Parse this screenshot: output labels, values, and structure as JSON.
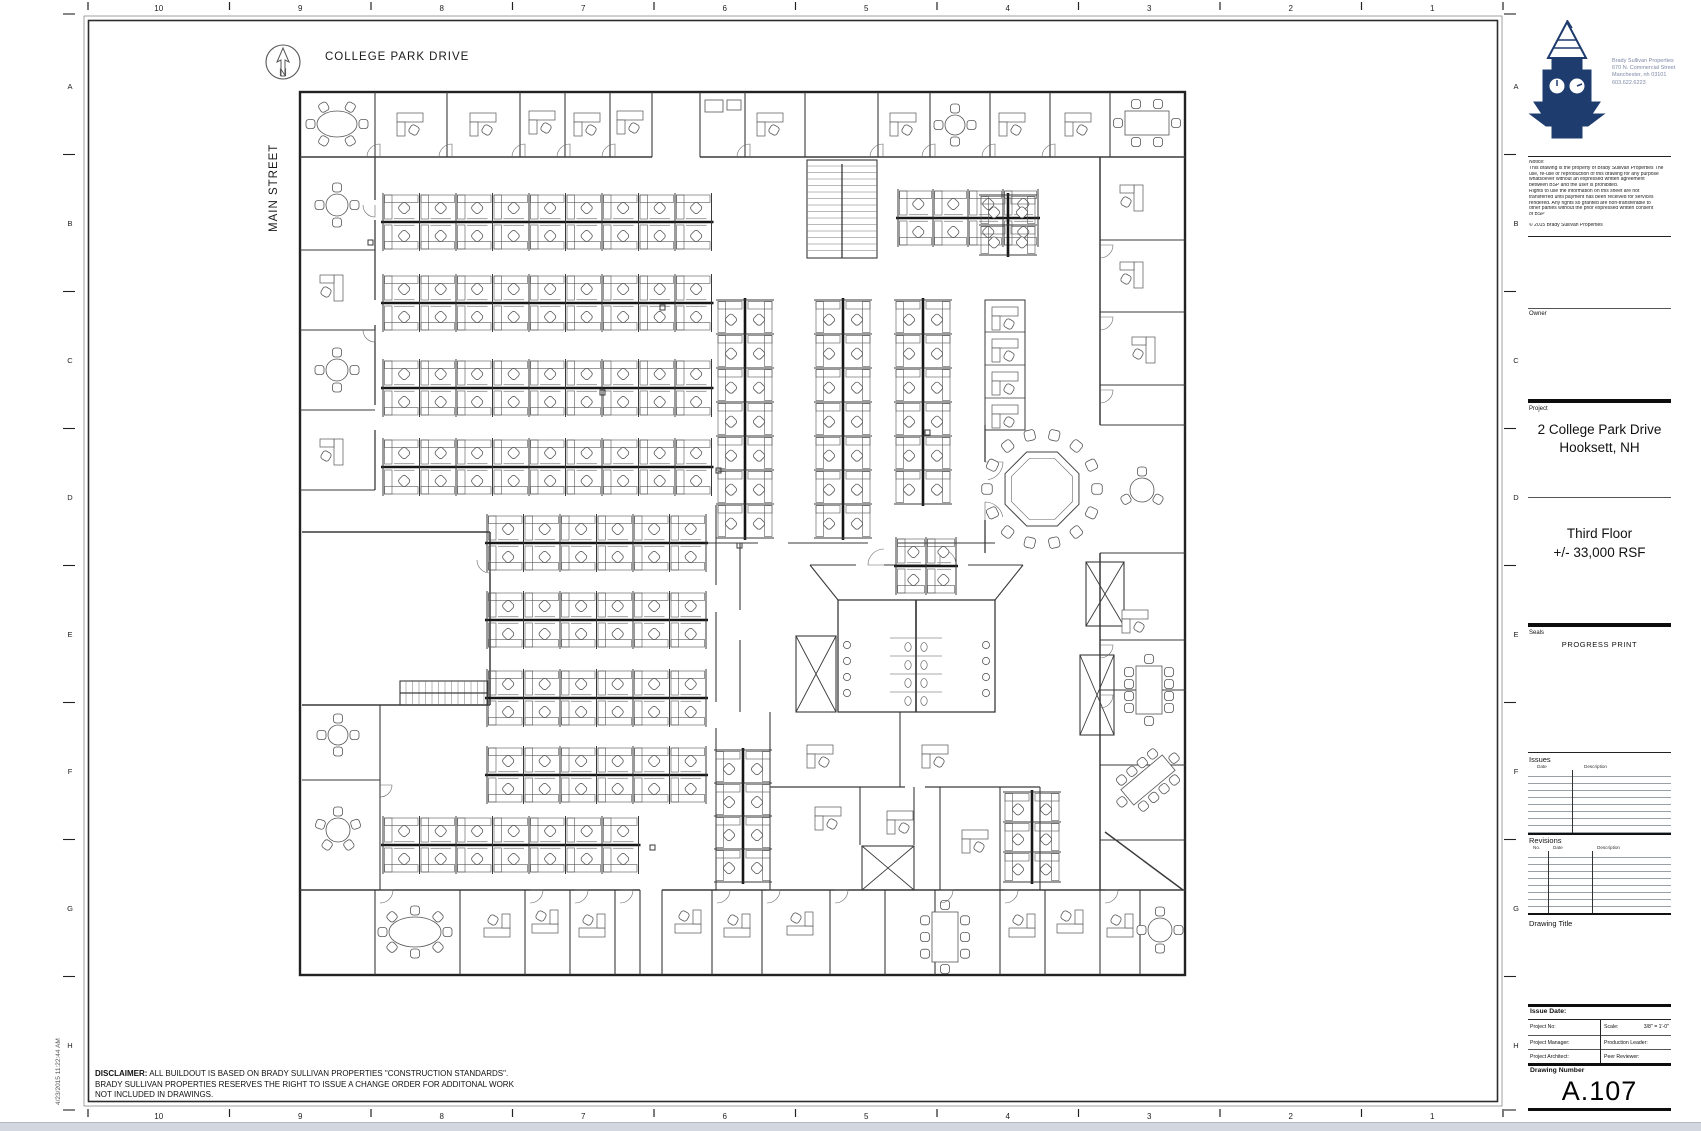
{
  "ruler": {
    "tick": "I",
    "top_numbers": [
      "10",
      "9",
      "8",
      "7",
      "6",
      "5",
      "4",
      "3",
      "2",
      "1"
    ],
    "bottom_numbers": [
      "10",
      "9",
      "8",
      "7",
      "6",
      "5",
      "4",
      "3",
      "2",
      "1"
    ],
    "left_letters": [
      "A",
      "B",
      "C",
      "D",
      "E",
      "F",
      "G",
      "H"
    ],
    "right_letters": [
      "A",
      "B",
      "C",
      "D",
      "E",
      "F",
      "G",
      "H"
    ]
  },
  "plan": {
    "street_top": "COLLEGE PARK DRIVE",
    "street_left": "MAIN STREET",
    "north_letter": "N"
  },
  "timestamp": "4/23/2015 11:22:44 AM",
  "disclaimer": {
    "label": "DISCLAIMER:",
    "text1": " ALL BUILDOUT IS BASED ON BRADY SULLIVAN PROPERTIES \"CONSTRUCTION STANDARDS\".",
    "line2": "BRADY SULLIVAN PROPERTIES RESERVES THE RIGHT TO ISSUE A CHANGE ORDER FOR ADDITONAL WORK",
    "line3": "NOT INCLUDED IN DRAWINGS."
  },
  "title_block": {
    "firm": {
      "name": "Brady Sullivan Properties",
      "address1": "670 N. Commercial Street",
      "address2": "Manchester, nh 03101",
      "phone": "603.622.6223"
    },
    "notice": {
      "label": "Notice:",
      "lines": [
        "This drawing is the property of Brady Sullivan Properties The",
        "use, re-use or reproduction of this drawing for any purpose",
        "whatsoever without an expressed written agreement",
        "between BSP and the user is prohibited.",
        "Rights to use the  information on this sheet are not",
        "transferred until payment has been  received for services",
        "rendered. Any rights so granted are non-transferable to",
        "other parties without  the prior expressed written consent",
        "of BSP"
      ],
      "copyright": "© 2015 Brady Sullivan Properties"
    },
    "owner_label": "Owner",
    "project_label": "Project",
    "project_line1": "2 College Park Drive",
    "project_line2": "Hooksett, NH",
    "floor_line1": "Third Floor",
    "floor_line2": "+/-  33,000 RSF",
    "seals_label": "Seals",
    "seals_stamp": "PROGRESS PRINT",
    "issues": {
      "label": "Issues",
      "col_date": "Date",
      "col_desc": "Description",
      "rows": 9
    },
    "revisions": {
      "label": "Revisions",
      "col_no": "No.",
      "col_date": "Date",
      "col_desc": "Description",
      "rows": 9
    },
    "drawing_title_label": "Drawing Title",
    "fields": {
      "issue_date": "Issue Date:",
      "project_no": "Project No:",
      "scale_label": "Scale:",
      "scale_value": "3/8\" = 1'-0\"",
      "project_manager": "Project Manager:",
      "production_leader": "Production Leader:",
      "project_architect": "Project Architect:",
      "peer_reviewer": "Peer Reviewer:"
    },
    "drawing_number_label": "Drawing Number",
    "drawing_number": "A.107"
  },
  "colors": {
    "logo_navy": "#1e3c6e",
    "line": "#3a3a3a"
  }
}
